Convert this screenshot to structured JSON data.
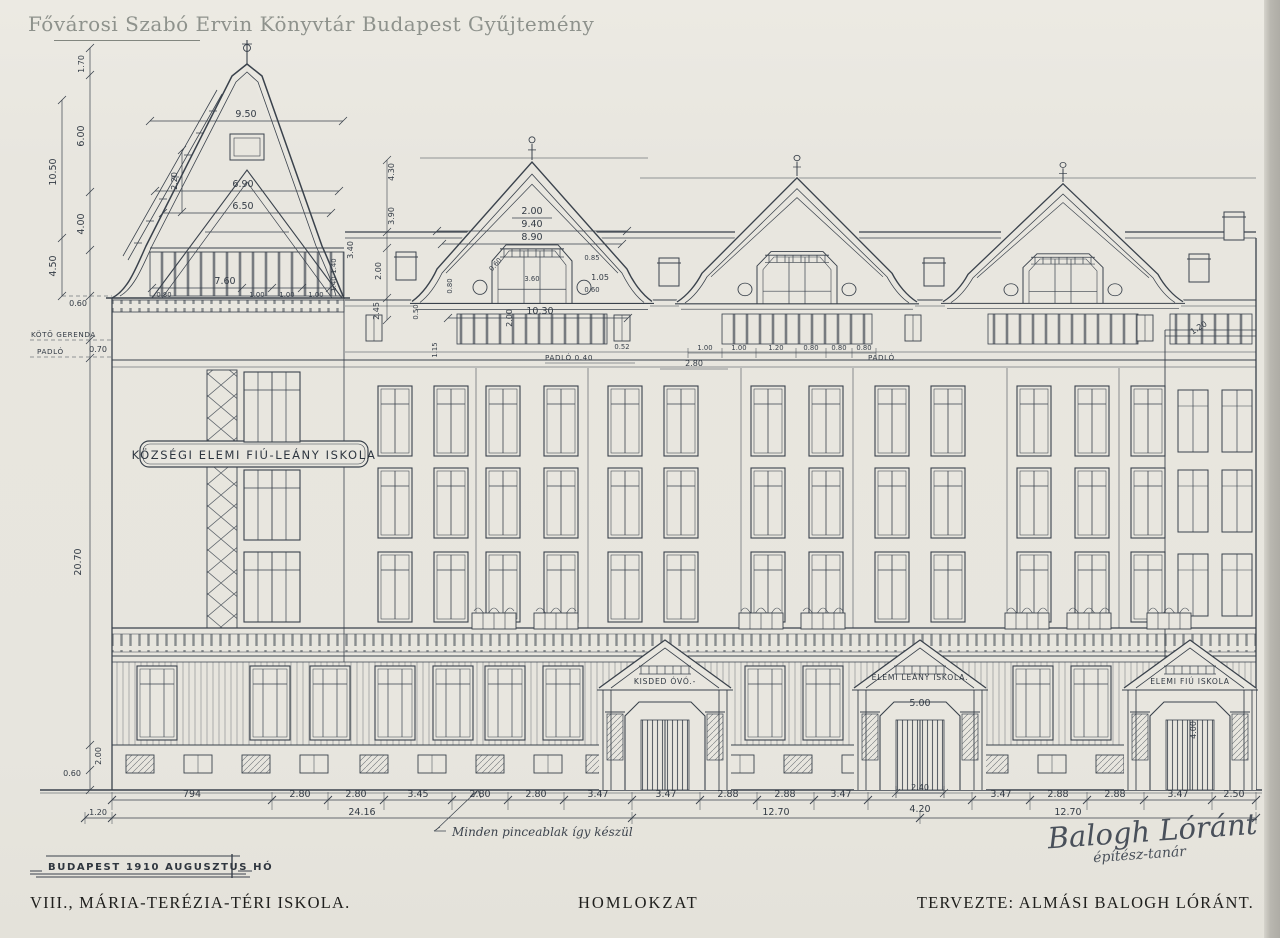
{
  "colors": {
    "paper": "#e8e6df",
    "ink": "#3a424c",
    "watermark": "#8e928c",
    "scan_edge": "#b9b7b0"
  },
  "watermark": {
    "text": "Fővárosi Szabó Ervin Könyvtár Budapest Gyűjtemény"
  },
  "building": {
    "banner": "KÖZSÉGI ELEMI FIÚ-LEÁNY ISKOLA",
    "entrance_labels": {
      "left": "KISDED ÓVÓ.-",
      "center": "ELEMI LEÁNY ISKOLA.",
      "right": "ELEMI FIÚ ISKOLA"
    },
    "entrance_heights": {
      "center": "5.00",
      "right": "4.00"
    }
  },
  "levels": {
    "tie_beam": "KÖTŐ GERENDA",
    "floor": "PADLÓ",
    "floor_mark": "PADLÓ 0.40"
  },
  "dims": {
    "bottom": [
      "794",
      "2.80",
      "2.80",
      "3.45",
      "2.80",
      "2.80",
      "3.47",
      "3.47",
      "2.88",
      "2.88",
      "3.47",
      "4.20",
      "3.47",
      "2.88",
      "2.88",
      "3.47",
      "2.50"
    ],
    "gate_width": "2.40",
    "totals": [
      "1.20",
      "24.16",
      "12.70",
      "12.70"
    ],
    "left": {
      "a": "1.70",
      "b": "6.00",
      "c": "4.00",
      "d": "10.50",
      "e": "4.50",
      "f": "0.60",
      "g": "0.70",
      "h": "20.70",
      "i": "2.00",
      "j": "0.60"
    },
    "tower": {
      "w": "9.50",
      "g1": "6.90",
      "g2": "6.50",
      "v": "2.20",
      "base": "7.60",
      "s1": "0.80",
      "s2": "1.00",
      "s3": "1.00",
      "s4": "1.00",
      "r": "3.40",
      "r2": "1.40"
    },
    "gable": {
      "a": "2.00",
      "b": "9.40",
      "c": "8.90",
      "d": "0.85",
      "e": "1.05",
      "f": "0.60",
      "g": "3.60",
      "h": "0.80",
      "i": "10.30",
      "j": "2.00",
      "k": "0.52",
      "l": "1.15"
    },
    "mid": {
      "a": "4.30",
      "b": "3.90",
      "c": "2.00",
      "d": "2.45",
      "e": "0.50"
    },
    "attic": {
      "a": "1.00",
      "b": "1.00",
      "c": "1.20",
      "d": "0.80",
      "e": "0.80",
      "f": "0.80",
      "g": "2.80"
    },
    "right": {
      "a": "1.20"
    }
  },
  "notes": {
    "basement": "Minden pinceablak így készül",
    "date_stamp": "BUDAPEST 1910 AUGUSZTUS HÓ",
    "signature": "Balogh Lóránt",
    "signature_title": "építész-tanár"
  },
  "footer": {
    "left": "VIII., MÁRIA-TERÉZIA-TÉRI ISKOLA.",
    "center": "HOMLOKZAT",
    "right": "TERVEZTE: ALMÁSI BALOGH LÓRÁNT."
  }
}
